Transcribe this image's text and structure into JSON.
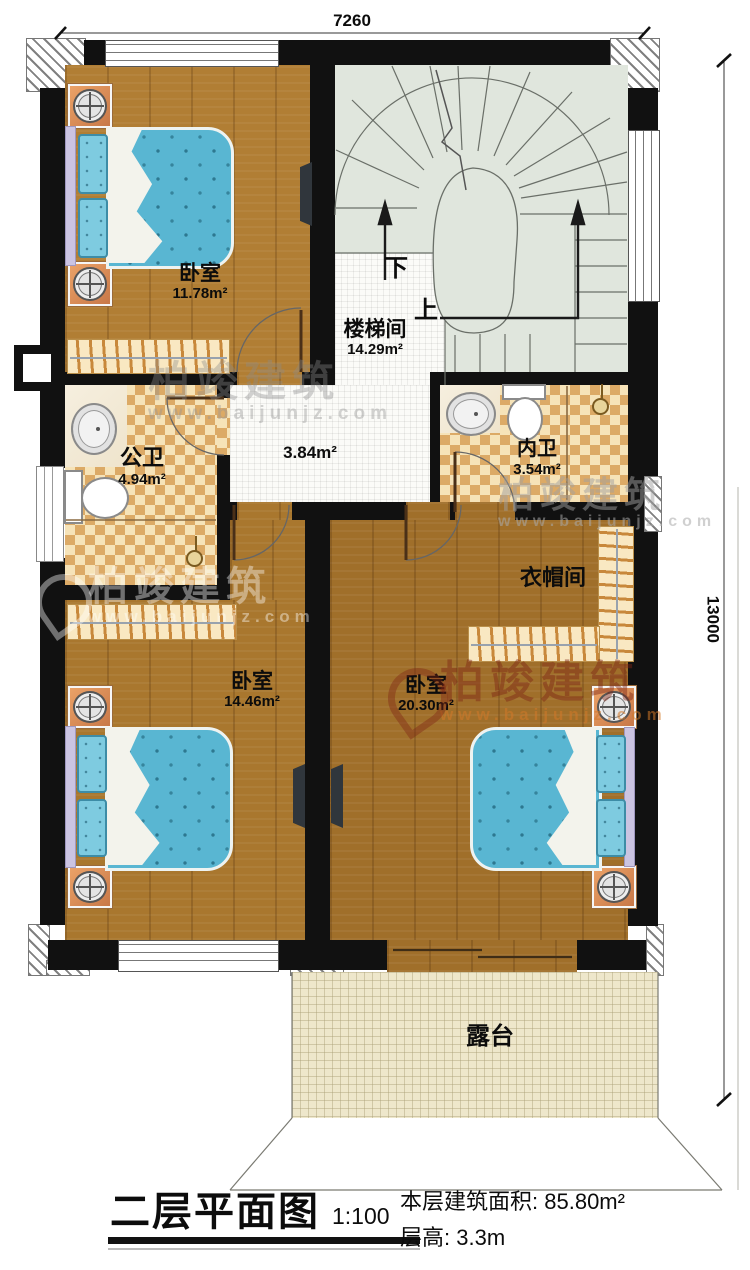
{
  "dimensions": {
    "top": "7260",
    "right": "13000"
  },
  "rooms": {
    "bedroom1": {
      "name": "卧室",
      "area": "11.78m²"
    },
    "stairwell": {
      "name": "楼梯间",
      "area": "14.29m²"
    },
    "hallway": {
      "area": "3.84m²"
    },
    "public_bath": {
      "name": "公卫",
      "area": "4.94m²"
    },
    "private_bath": {
      "name": "内卫",
      "area": "3.54m²"
    },
    "cloakroom": {
      "name": "衣帽间"
    },
    "bedroom2": {
      "name": "卧室",
      "area": "14.46m²"
    },
    "bedroom3": {
      "name": "卧室",
      "area": "20.30m²"
    },
    "terrace": {
      "name": "露台"
    }
  },
  "stairs": {
    "down": "下",
    "up": "上"
  },
  "watermark": {
    "brand": "柏竣建筑",
    "url": "www.baijunjz.com"
  },
  "titleblock": {
    "title": "二层平面图",
    "scale": "1:100",
    "area_label": "本层建筑面积:",
    "area_value": "85.80m²",
    "floor_height_label": "层高:",
    "floor_height_value": "3.3m"
  },
  "colors": {
    "wall": "#111111",
    "wood": "#a9772e",
    "bed_blue": "#59b6d2",
    "checker_tan": "#dcaa66",
    "stair_floor": "#e0e6dd",
    "terrace_tile": "#eee7cb",
    "watermark_red": "#7d2314"
  }
}
